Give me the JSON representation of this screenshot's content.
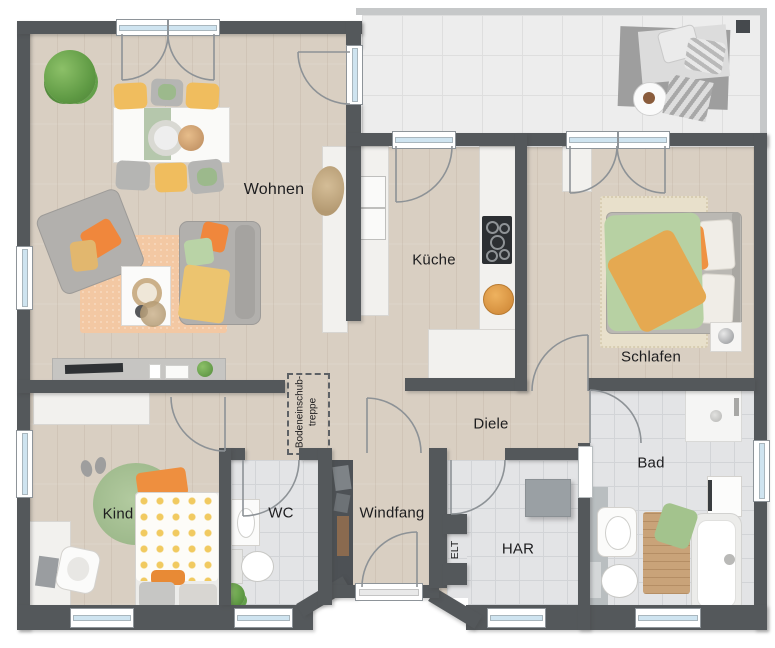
{
  "labels": {
    "wohnen": "Wohnen",
    "kueche": "Küche",
    "schlafen": "Schlafen",
    "diele": "Diele",
    "kind": "Kind",
    "wc": "WC",
    "windfang": "Windfang",
    "har": "HAR",
    "bad": "Bad",
    "elt": "ELT",
    "attic_line1": "Bodeneinschub-",
    "attic_line2": "treppe"
  },
  "colors": {
    "wall": "#54585b",
    "wood_floor": "#d9cfc2",
    "tile_floor": "#e3e4e6",
    "terrace_tile": "#ededed",
    "window_glass": "#cfe4f0",
    "accent_orange": "#ef8a3d",
    "accent_green": "#aecba0",
    "accent_yellow": "#eec05e",
    "sofa_gray": "#b2b0ad",
    "living_rug": "#f3c8a3",
    "kids_rug": "#a8c297",
    "bath_mat_wood": "#c9a379"
  }
}
